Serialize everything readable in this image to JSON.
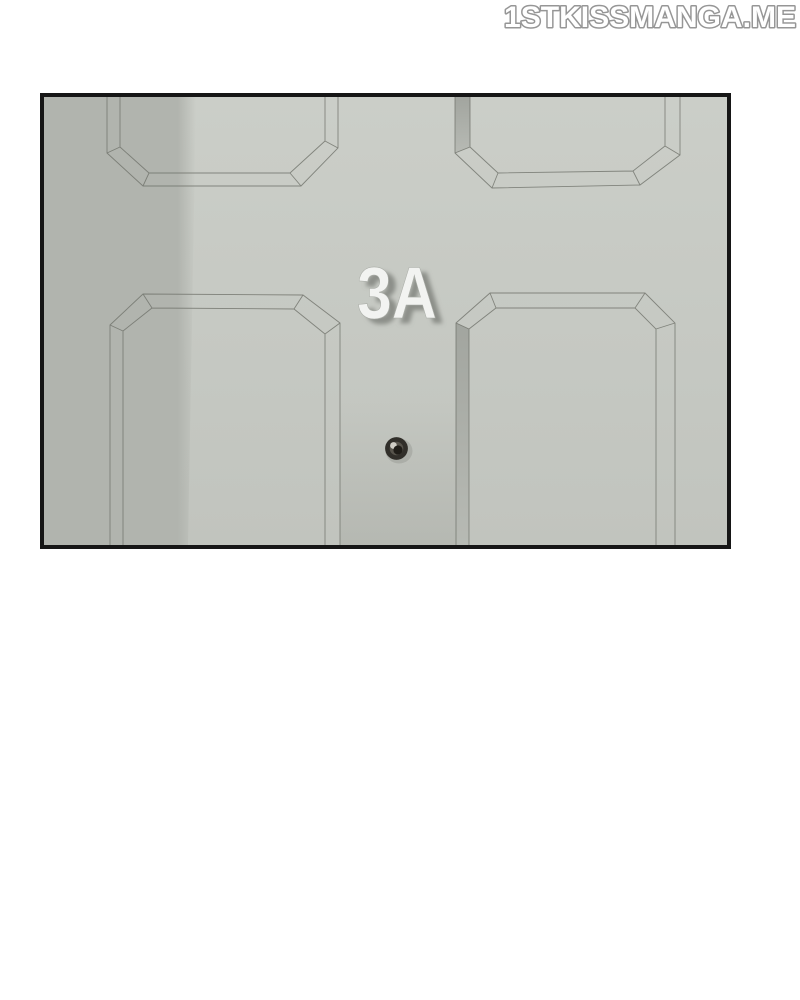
{
  "watermark": {
    "text": "1STKISSMANGA.ME",
    "fill": "#ffffff",
    "outline": "#969696"
  },
  "panel": {
    "door_label": "3A",
    "colors": {
      "frame_border": "#161616",
      "door_base_top": "#cbcec8",
      "door_base_bottom": "#c1c4be",
      "door_shadow": "#b1b4ae",
      "panel_line": "#6f726a",
      "bevel_dark": "#a2a59f",
      "bevel_light": "#b7bab4",
      "label_fill": "#f2f3f1",
      "label_outline": "#aaada7",
      "label_shadow": "#7d807a",
      "peephole_ring": "#312f2a",
      "peephole_mid": "#57544c",
      "peephole_highlight": "#cfcdc5",
      "peephole_hole": "#1f1d18"
    }
  }
}
